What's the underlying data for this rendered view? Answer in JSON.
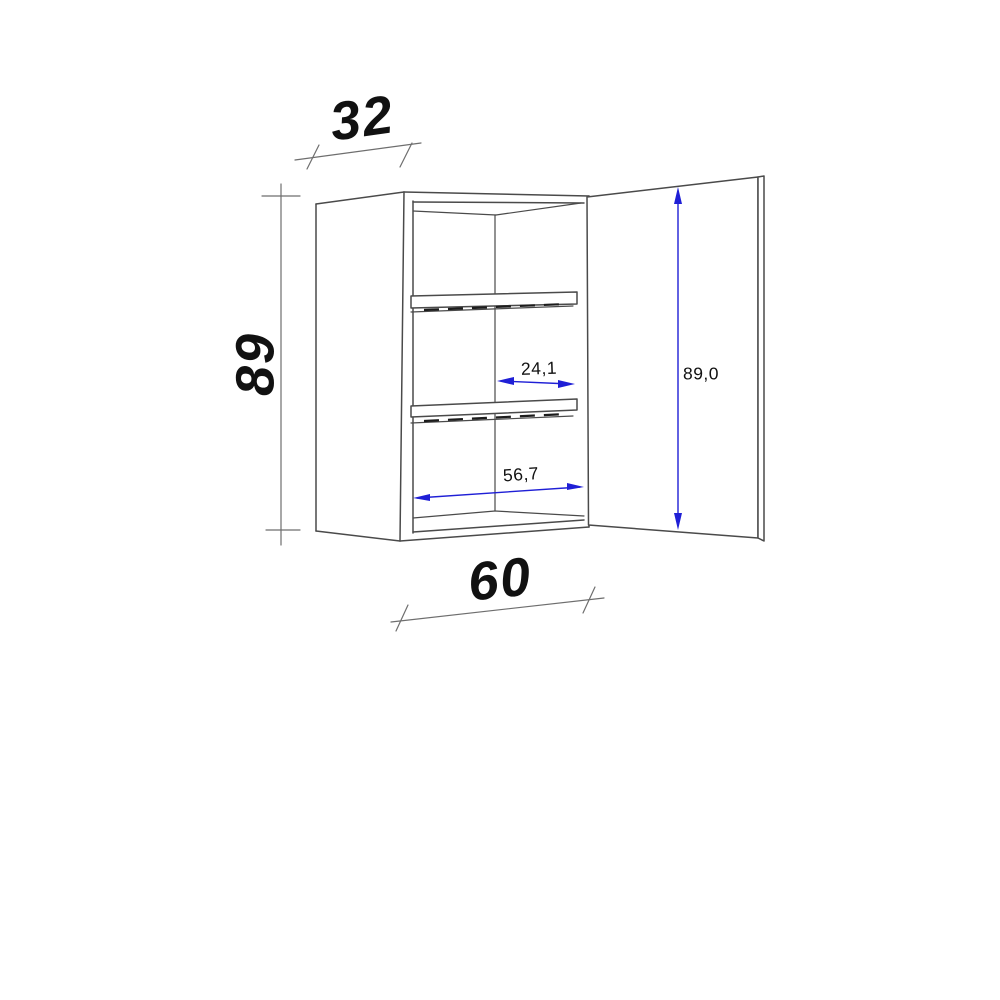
{
  "drawing": {
    "subject": "wall-cabinet-with-open-door-and-two-shelves",
    "dimensions": {
      "depth": "32",
      "height": "89",
      "width": "60",
      "inner_horizontal": "24,1",
      "inner_width": "56,7",
      "door_height": "89,0"
    }
  },
  "colors": {
    "drawing_line": "#4a4a4a",
    "dimension_line": "#6e6e6e",
    "accent_blue": "#1f1fd6",
    "label_text": "#111111"
  }
}
